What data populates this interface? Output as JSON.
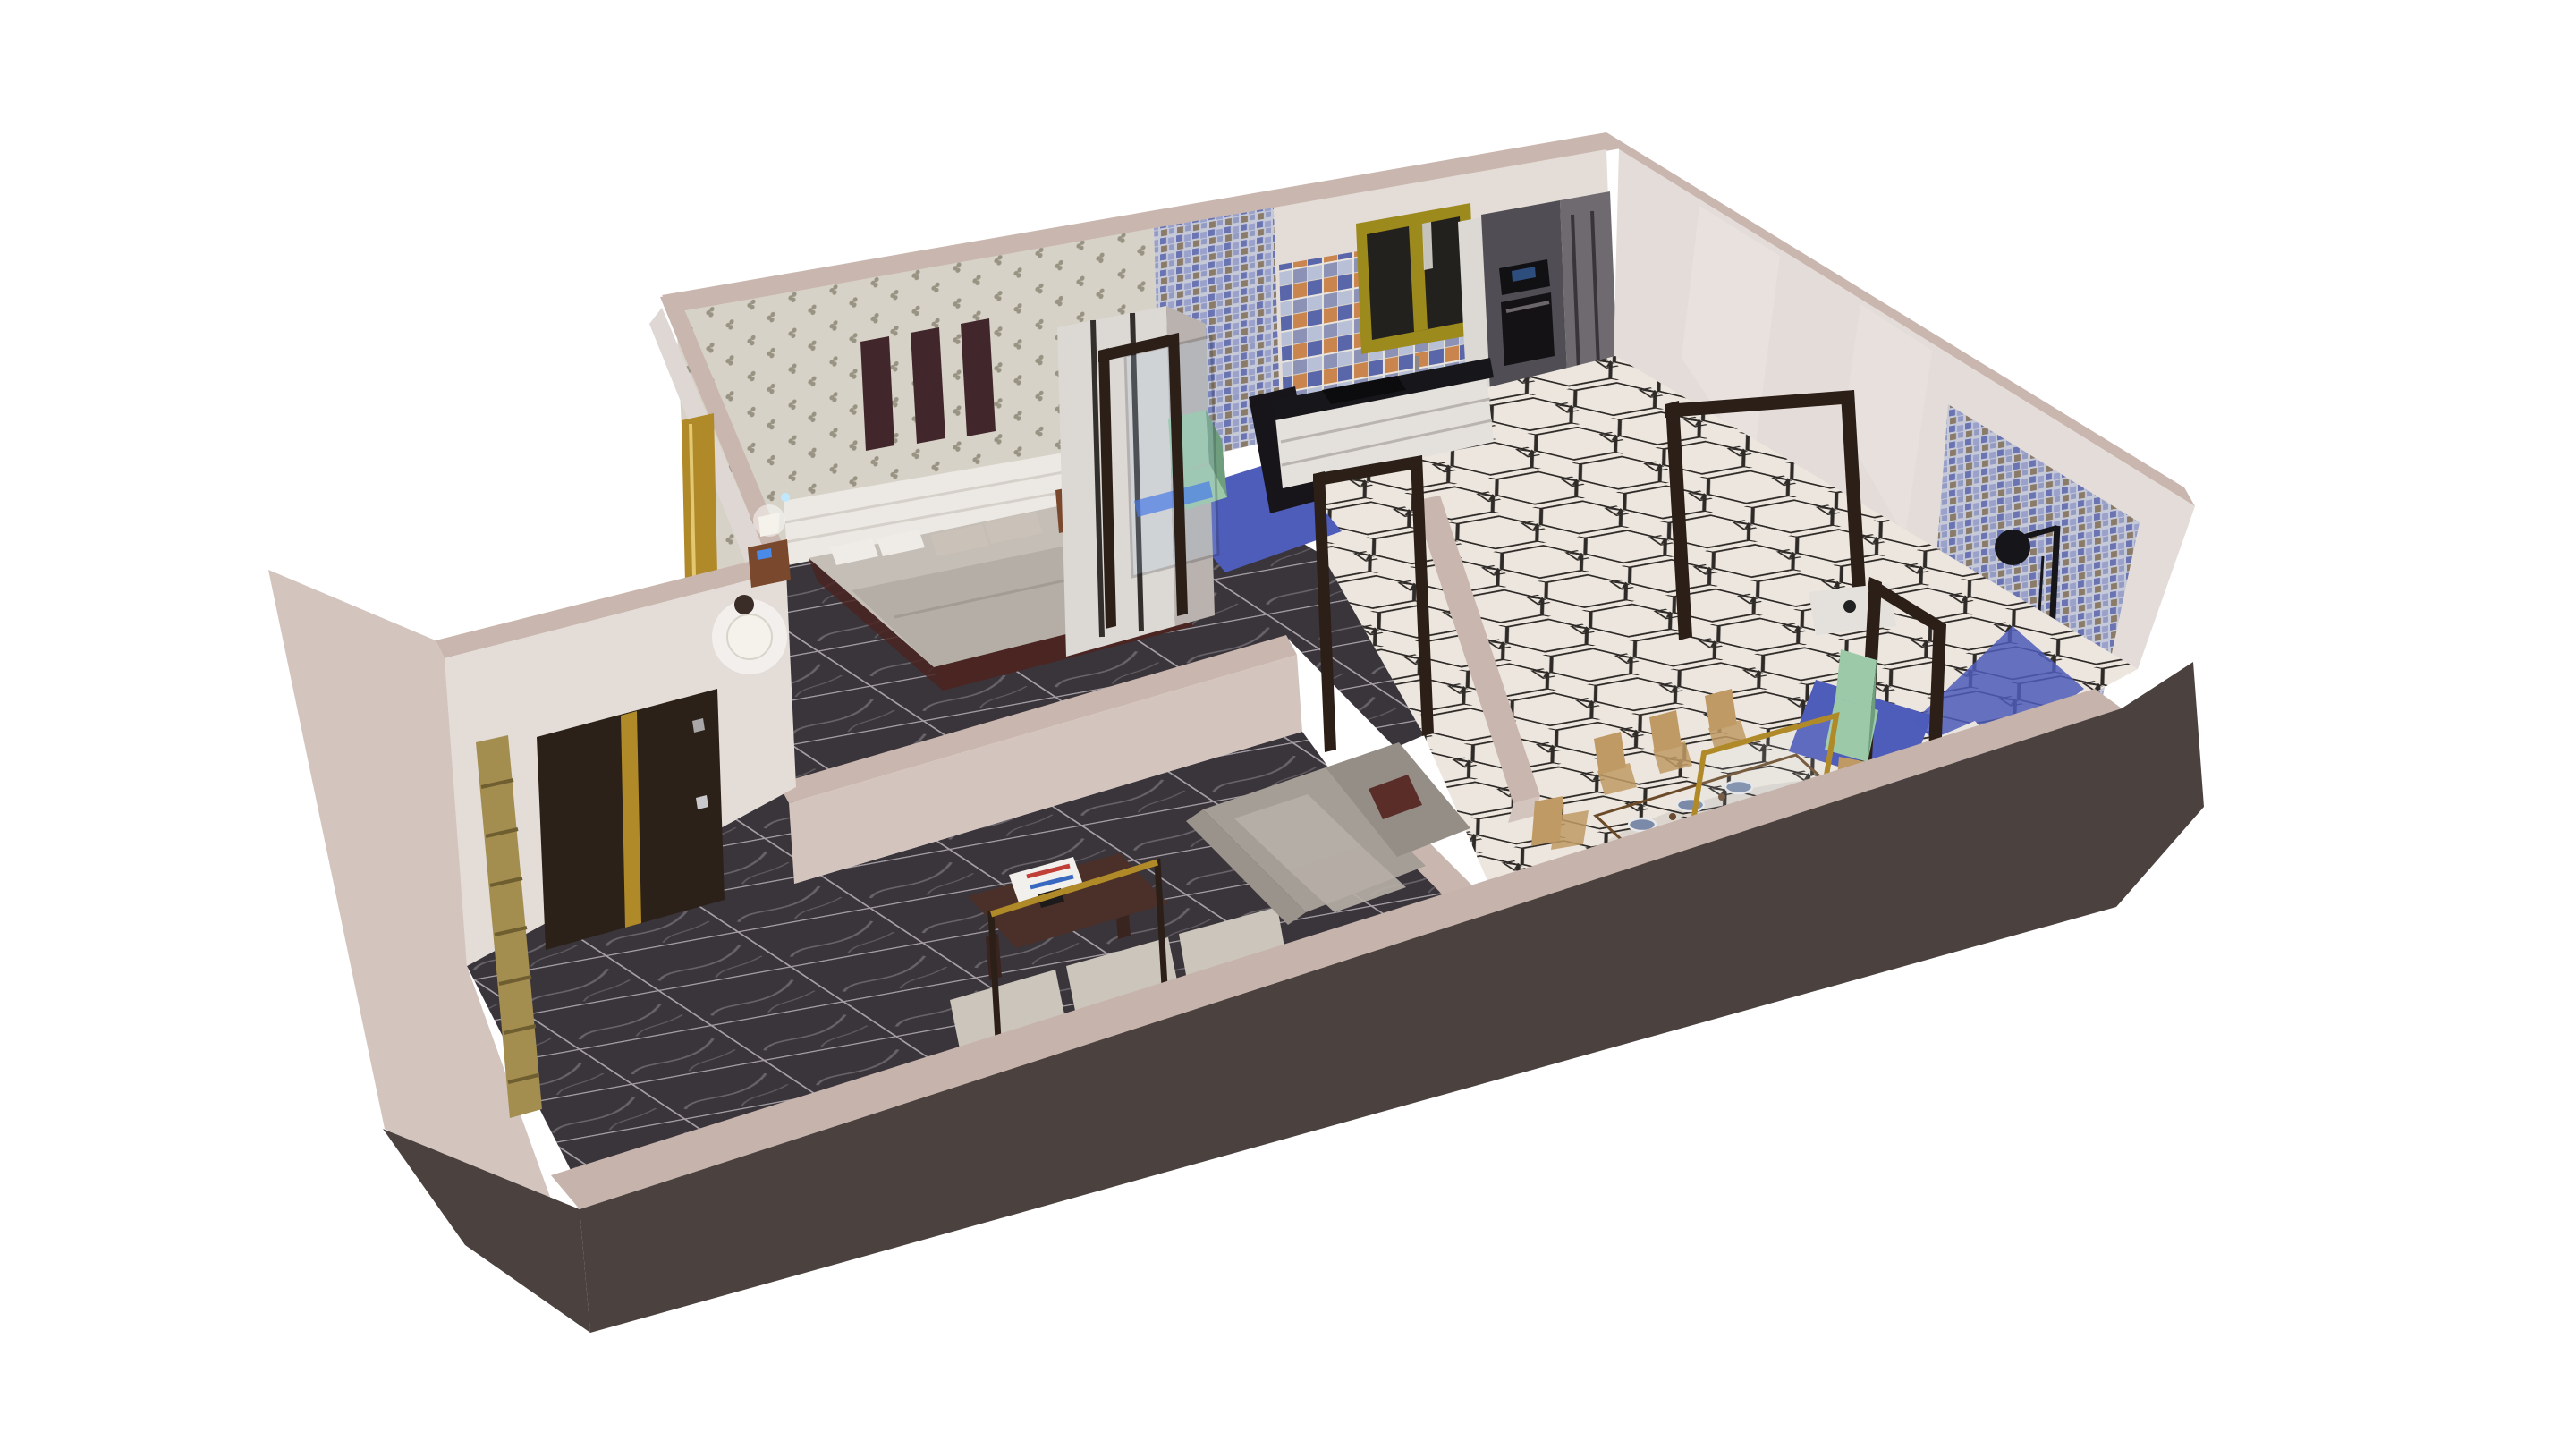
{
  "scene": {
    "title": "3D apartment cutaway floor plan render",
    "style": "isometric cutaway render on white background, walls cut at waist height",
    "rooms": [
      {
        "name": "bedroom",
        "floor": "dark marble tile",
        "walls": "floral wallpaper with three dark art panels",
        "furniture": [
          "double bed with white slatted headboard",
          "grey blanket",
          "patterned pillows",
          "two wooden nightstands",
          "two table lamps",
          "tall wardrobe"
        ]
      },
      {
        "name": "ensuite-bathroom",
        "floor": "blue tile",
        "walls": "blue mosaic",
        "furniture": [
          "green toilet",
          "glass partition with dark frame",
          "blue LED floor glow"
        ]
      },
      {
        "name": "kitchen",
        "floor": "cream hexagon tile with black ornament",
        "walls": "patchwork tile backsplash",
        "furniture": [
          "white drawer cabinets",
          "dark countertop",
          "black cooktop",
          "tall dark appliance cabinet with oven and microwave",
          "yellow framed window"
        ]
      },
      {
        "name": "hallway",
        "floor": "cream hexagon tile with black ornament",
        "furniture": [
          "open dark-brown door frames"
        ]
      },
      {
        "name": "dining-room",
        "floor": "cream hexagon tile with black ornament",
        "furniture": [
          "rectangular wooden dining table",
          "eight wooden chairs",
          "six blue place settings",
          "gold framed glass partition"
        ]
      },
      {
        "name": "living-room",
        "floor": "dark marble tile",
        "furniture": [
          "grey sectional sofa",
          "dark red cushion",
          "dark wooden coffee table",
          "magazine",
          "metal frame console with brass top",
          "bench cushions along front wall"
        ]
      },
      {
        "name": "entry",
        "walls": "white",
        "furniture": [
          "dark entry door with brass stripe and silver handle",
          "white sphere pendant lamp",
          "brass wall trim",
          "wooden slat panel outside the wall"
        ]
      },
      {
        "name": "bathroom",
        "floor": "blue tile",
        "walls": "blue mosaic",
        "furniture": [
          "green toilet",
          "black rain shower set",
          "white vanity top",
          "dark door frame"
        ]
      }
    ]
  },
  "palette": {
    "background": "#ffffff",
    "wallCap": "#c9b6ae",
    "wallFace": "#d3c4bd",
    "wallLight": "#e3dcd7",
    "wallGlossy": "#e4dcd8",
    "cutWallCap": "#c6b3ab",
    "cutWallDark": "#4b4240",
    "wallpaperBg": "#d7d2c7",
    "wallpaperPrint": "#8d8877",
    "panelDark": "#41262b",
    "marbleBase": "#3a353b",
    "marbleGrout": "#b6b0b6",
    "marbleVein": "#969098",
    "hexBg": "#ece6de",
    "hexLine": "#2e2a27",
    "mosaicBase": "#c6c9d8",
    "mosaicA": "#6a74b2",
    "mosaicB": "#9aa2cc",
    "mosaicC": "#8a7a68",
    "patchA": "#5a66aa",
    "patchB": "#c87838",
    "patchC": "#d8d2c8",
    "windowFrame": "#9c8a1c",
    "windowGlass": "#23211d",
    "cabinetDark": "#514d54",
    "cabinetMid": "#6e6a70",
    "cabinetLight": "#dcd8d4",
    "counterWhite": "#e4e0dc",
    "counterTop": "#17161a",
    "cooktop": "#0c0c0e",
    "toiletGreen": "#9ccaa8",
    "bathFloorBlue": "#4e5cba",
    "doorDark": "#2c2118",
    "brass": "#b08a28",
    "handleSilver": "#c9c9cd",
    "frameBrown": "#2b1f18",
    "sofaGray": "#a59e96",
    "sofaBack": "#958e86",
    "sofaCushion": "#b5aea6",
    "pillowRed": "#5a2d28",
    "benchCushion": "#ccc5bb",
    "woodTable": "#b0885a",
    "woodRunner": "#c89a66",
    "woodChair": "#c09a64",
    "woodDark": "#6a4a28",
    "tableLegs": "#5a3a22",
    "plateBlue": "#7a8aa8",
    "coffeeTable": "#4a3028",
    "nightstandWood": "#7a482c",
    "bedFrame": "#4a2522",
    "mattress": "#c4beb6",
    "blanket": "#b5aea6",
    "headboard": "#ece9e4",
    "lampWhite": "#f4f2ea",
    "ledBlue": "#4a8ae8",
    "glowBlue": "#2f66e8",
    "slatWood": "#a38e50",
    "glassTint": "#a8c4e0",
    "showerBlack": "#16161a",
    "stubDark": "#17151a"
  }
}
